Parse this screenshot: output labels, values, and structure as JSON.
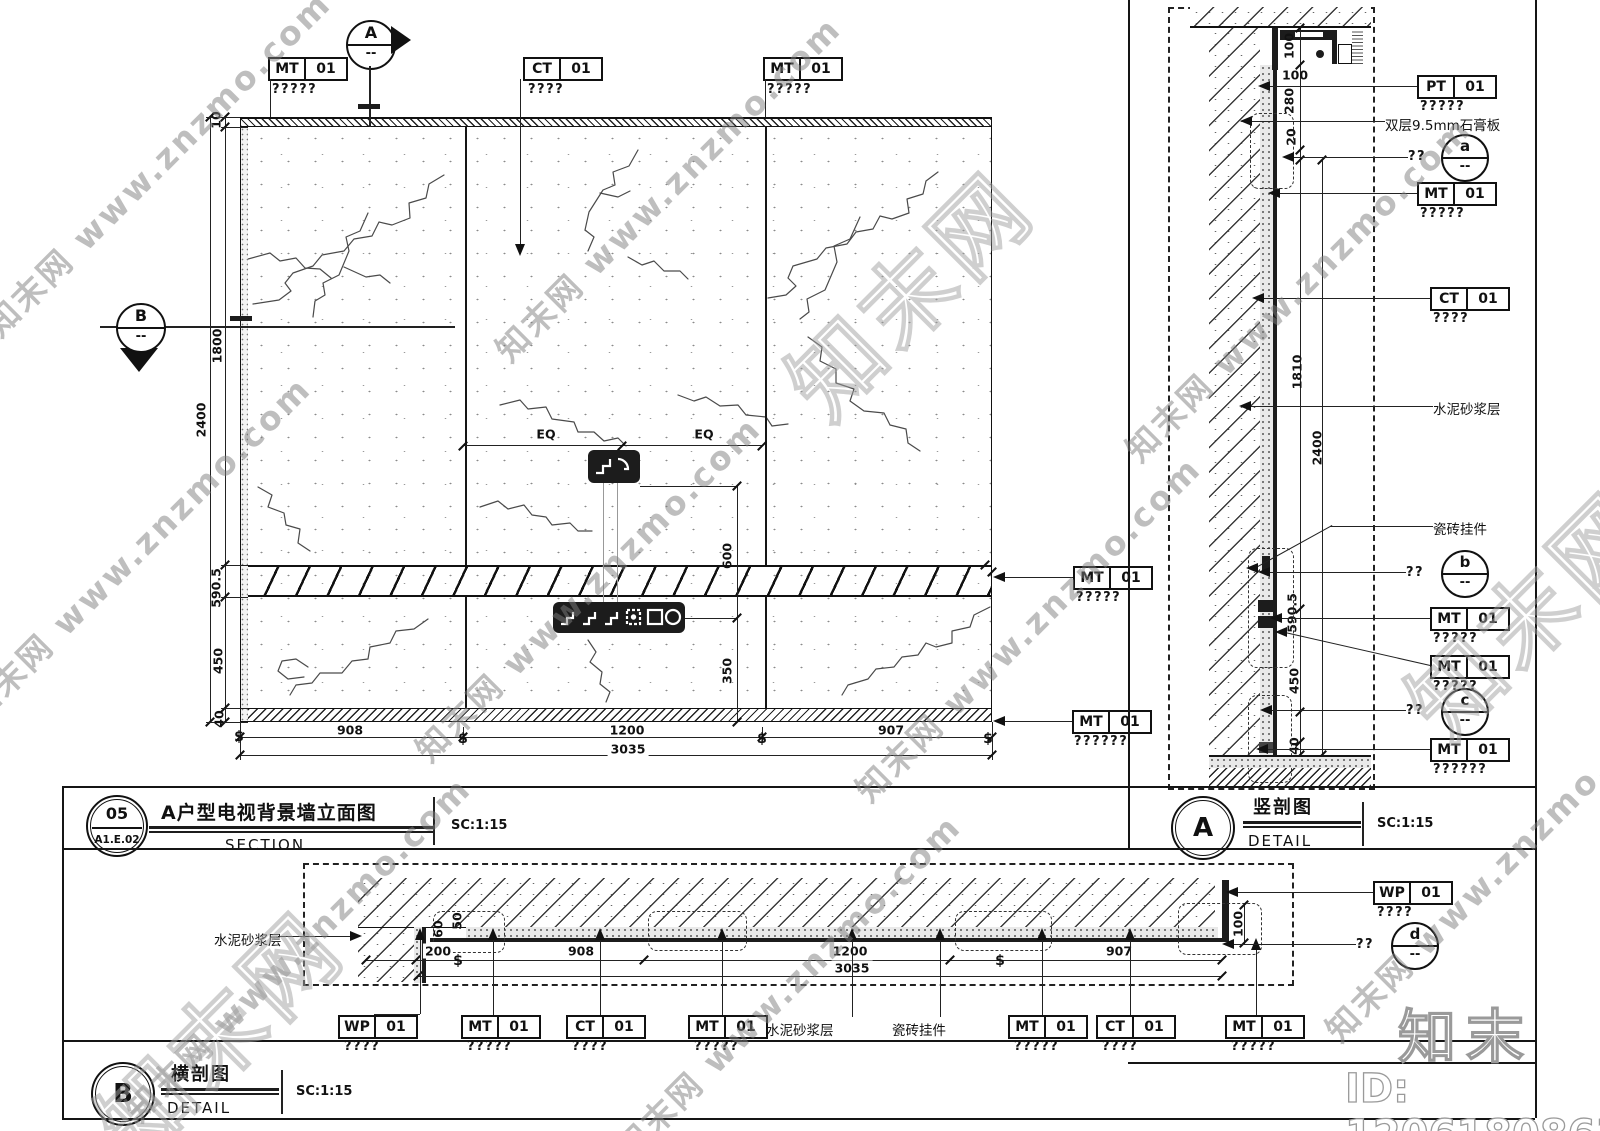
{
  "watermark": {
    "text": "知末网 www.znzmo.com",
    "outline_text": "知末网",
    "logo": "知末",
    "id_label": "ID: 1206180863"
  },
  "elevation": {
    "block_no": "05",
    "sheet_no": "A1.E.02",
    "title": "A户型电视背景墙立面图",
    "subtitle": "SECTION",
    "scale": "SC:1:15",
    "marker_a": "A",
    "marker_b": "B",
    "marker_dash": "--",
    "tags_top": [
      {
        "code": "MT",
        "num": "01",
        "note": "?????"
      },
      {
        "code": "CT",
        "num": "01",
        "note": "????"
      },
      {
        "code": "MT",
        "num": "01",
        "note": "?????"
      }
    ],
    "tags_right": [
      {
        "code": "MT",
        "num": "01",
        "note": "?????"
      },
      {
        "code": "MT",
        "num": "01",
        "note": "??????"
      }
    ],
    "dims": {
      "top": "10",
      "upper": "1800",
      "band": "590.5",
      "lower": "450",
      "base": "40",
      "total_height": "2400",
      "eq_left": "EQ",
      "eq_right": "EQ",
      "tv": "600",
      "console": "350",
      "w1": "908",
      "w2": "1200",
      "w3": "907",
      "total_width": "3035",
      "break": "$"
    }
  },
  "section_a": {
    "letter": "A",
    "title": "竖剖图",
    "subtitle": "DETAIL",
    "scale": "SC:1:15",
    "labels": {
      "gypsum": "双层9.5mm石膏板",
      "mortar": "水泥砂浆层",
      "clip": "瓷砖挂件"
    },
    "tags": [
      {
        "code": "PT",
        "num": "01",
        "note": "?????"
      },
      {
        "code": "MT",
        "num": "01",
        "note": "?????"
      },
      {
        "code": "CT",
        "num": "01",
        "note": "????"
      },
      {
        "code": "MT",
        "num": "01",
        "note": "?????"
      },
      {
        "code": "MT",
        "num": "01",
        "note": "?????"
      },
      {
        "code": "MT",
        "num": "01",
        "note": "??????"
      }
    ],
    "details": [
      {
        "mark": "??",
        "letter": "a",
        "dash": "--"
      },
      {
        "mark": "??",
        "letter": "b",
        "dash": "--"
      },
      {
        "mark": "??",
        "letter": "c",
        "dash": "--"
      }
    ],
    "dims": {
      "d100_top": "100",
      "d100_side": "100",
      "d280": "280",
      "d20": "20",
      "d1810": "1810",
      "d2400": "2400",
      "d590": "590.5",
      "d450": "450",
      "d40": "40"
    }
  },
  "section_b": {
    "letter": "B",
    "title": "横剖图",
    "subtitle": "DETAIL",
    "scale": "SC:1:15",
    "labels": {
      "mortar_left": "水泥砂浆层",
      "mortar_mid": "水泥砂浆层",
      "clip_mid": "瓷砖挂件"
    },
    "tags_bottom": [
      {
        "code": "WP",
        "num": "01",
        "note": "????"
      },
      {
        "code": "MT",
        "num": "01",
        "note": "?????"
      },
      {
        "code": "CT",
        "num": "01",
        "note": "????"
      },
      {
        "code": "MT",
        "num": "01",
        "note": "?????"
      },
      {
        "code": "MT",
        "num": "01",
        "note": "?????"
      },
      {
        "code": "CT",
        "num": "01",
        "note": "????"
      },
      {
        "code": "MT",
        "num": "01",
        "note": "?????"
      }
    ],
    "tag_right": {
      "code": "WP",
      "num": "01",
      "note": "????"
    },
    "detail_d": {
      "mark": "??",
      "letter": "d",
      "dash": "--"
    },
    "dims": {
      "d200": "200",
      "d908": "908",
      "d1200": "1200",
      "d907": "907",
      "d3035": "3035",
      "d60": "60",
      "d50": "50",
      "d100": "100",
      "break": "$"
    }
  }
}
